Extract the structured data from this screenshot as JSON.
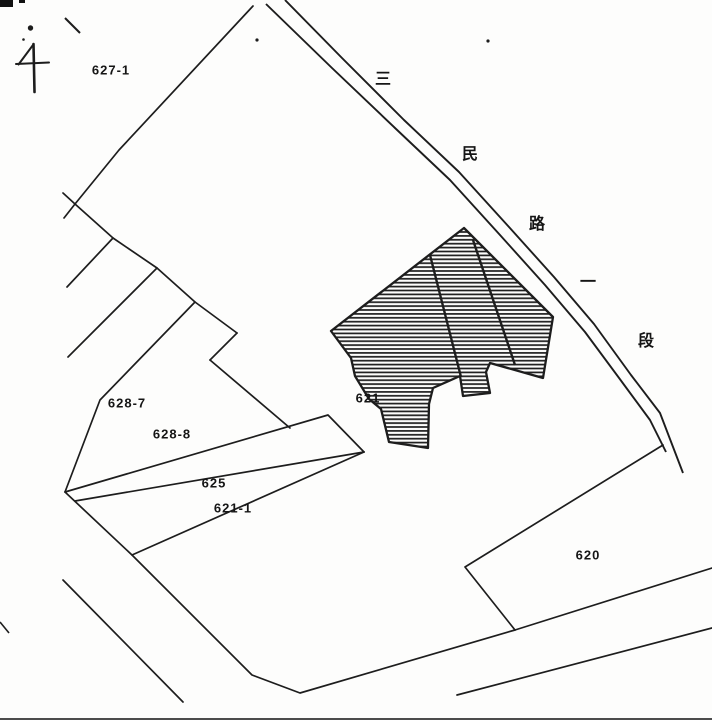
{
  "map": {
    "kind": "cadastral-map",
    "colors": {
      "paper": "#fdfdfc",
      "ink": "#1d1d1d"
    },
    "north_arrow": {
      "icon": "north-arrow-icon"
    },
    "road": {
      "full_name": "三民路一段",
      "chars": [
        "三",
        "民",
        "路",
        "一",
        "段"
      ]
    },
    "parcels": {
      "p627_1": {
        "label": "627-1"
      },
      "p628_7": {
        "label": "628-7"
      },
      "p628_8": {
        "label": "628-8"
      },
      "p625": {
        "label": "625"
      },
      "p621_1": {
        "label": "621-1"
      },
      "p621": {
        "label": "621"
      },
      "p620": {
        "label": "620"
      }
    },
    "building": {
      "on_parcel": "621",
      "fill_style": "hatched"
    }
  }
}
